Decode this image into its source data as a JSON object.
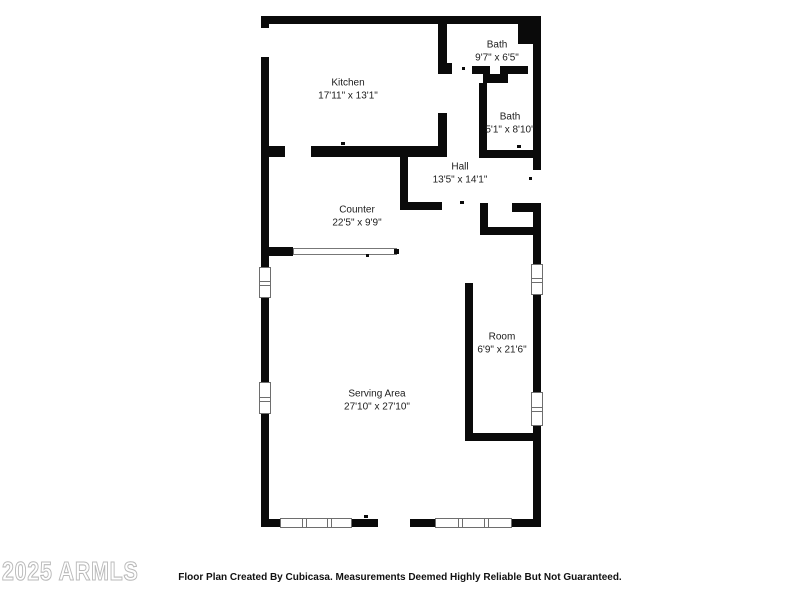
{
  "floorplan": {
    "rooms": [
      {
        "name": "Kitchen",
        "dims": "17'11\" x 13'1\""
      },
      {
        "name": "Bath",
        "dims": "9'7\" x 6'5\""
      },
      {
        "name": "Bath",
        "dims": "5'1\" x 8'10\""
      },
      {
        "name": "Hall",
        "dims": "13'5\" x 14'1\""
      },
      {
        "name": "Counter",
        "dims": "22'5\" x 9'9\""
      },
      {
        "name": "Room",
        "dims": "6'9\" x 21'6\""
      },
      {
        "name": "Serving Area",
        "dims": "27'10\" x 27'10\""
      }
    ],
    "colors": {
      "wall": "#0a0a0a",
      "label_text": "#1c1c1c",
      "window_border": "#6e6e6e",
      "watermark": "#bdbdbd"
    }
  },
  "footer": {
    "disclaimer": "Floor Plan Created By Cubicasa. Measurements Deemed Highly Reliable But Not Guaranteed."
  },
  "watermark": {
    "text": "2025 ARMLS"
  }
}
